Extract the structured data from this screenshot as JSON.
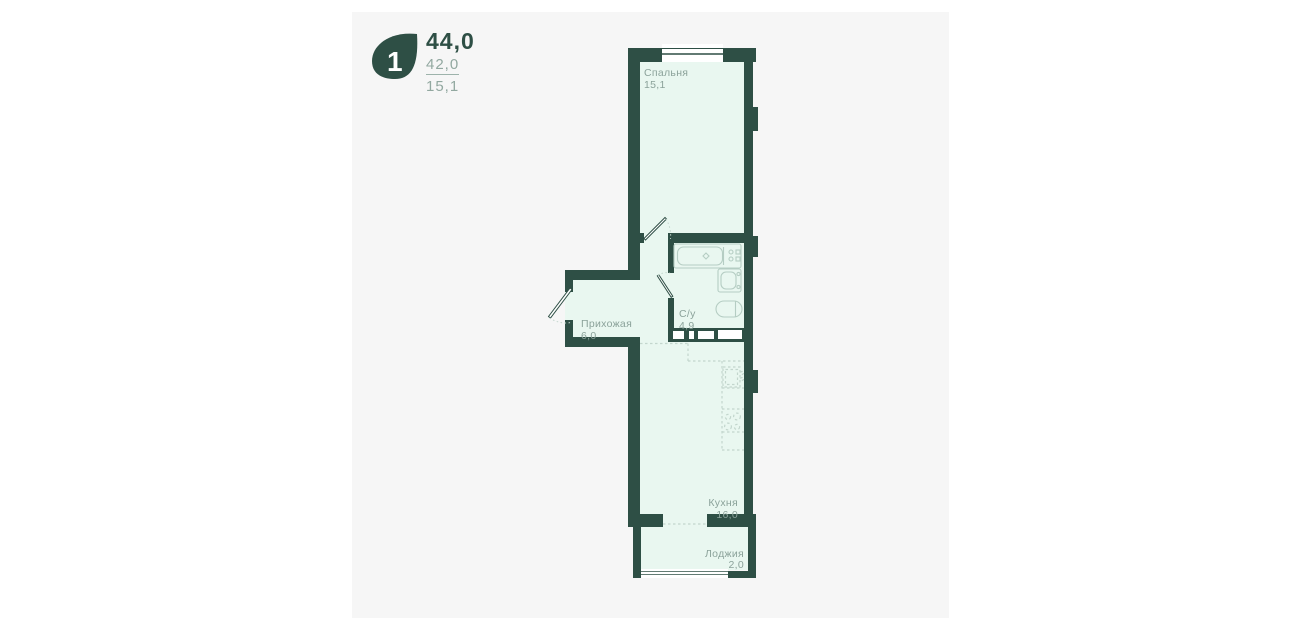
{
  "colors": {
    "wall": "#2e4f45",
    "room_fill": "#e9f7f0",
    "panel_bg": "#f6f6f6",
    "page_bg": "#ffffff",
    "white": "#ffffff",
    "fixture_line": "#b5cdc3",
    "dashed_line": "#c3d6cd",
    "label_text": "#8ba29a",
    "secondary_text": "#92a8a0"
  },
  "header": {
    "logo_number": "1",
    "total_area": "44,0",
    "living_area": "42,0",
    "first_room_area": "15,1"
  },
  "rooms": {
    "bedroom": {
      "label": "Спальня",
      "area": "15,1"
    },
    "hallway": {
      "label": "Прихожая",
      "area": "6,0"
    },
    "bathroom": {
      "label": "С/у",
      "area": "4,9"
    },
    "kitchen": {
      "label": "Кухня",
      "area": "16,0"
    },
    "loggia": {
      "label": "Лоджия",
      "area": "2,0"
    }
  }
}
